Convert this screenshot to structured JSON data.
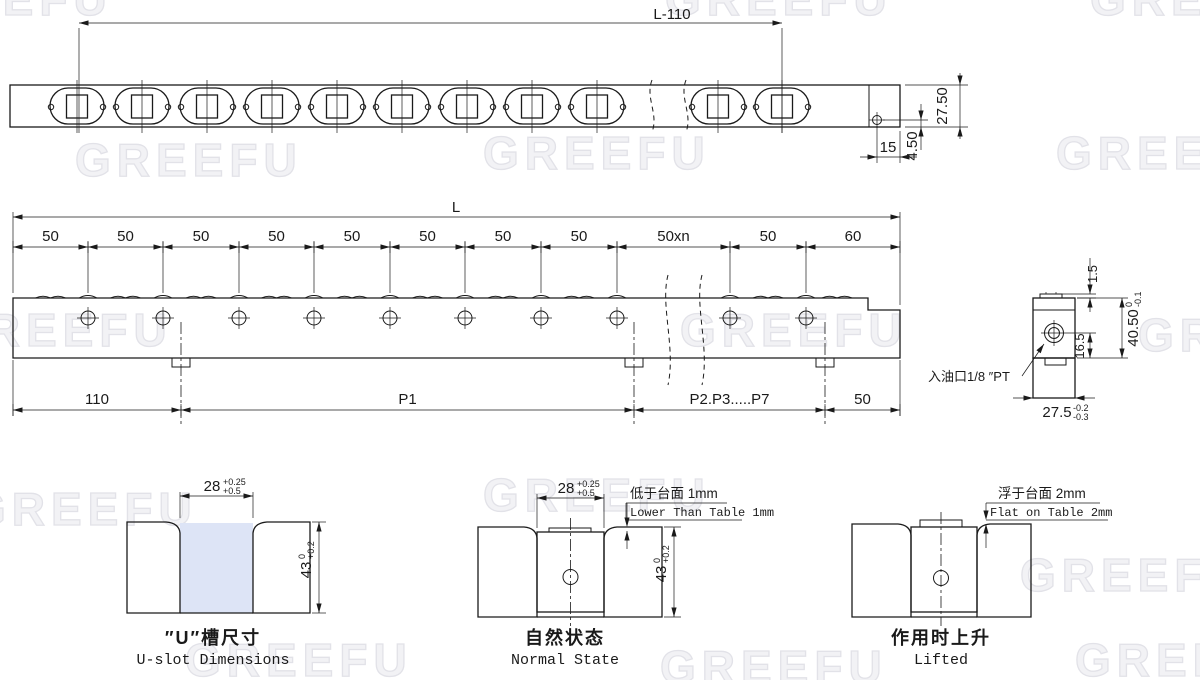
{
  "watermark": {
    "text": "GREEFU"
  },
  "top_view": {
    "length_dim": "L-110",
    "height_dim": "27.50",
    "hole_from_end": "15",
    "hole_from_bottom": "4.50"
  },
  "side_view": {
    "overall_dim": "L",
    "pitch_labels": [
      "50",
      "50",
      "50",
      "50",
      "50",
      "50",
      "50",
      "50",
      "50xn",
      "50",
      "60"
    ],
    "bottom_labels": [
      "110",
      "P1",
      "P2.P3.....P7",
      "50"
    ]
  },
  "section_view": {
    "crown_height": "1.5",
    "hole_to_bottom": "16.5",
    "body_height": {
      "value": "40.50",
      "upper": "0",
      "lower": "-0.1"
    },
    "body_width": {
      "value": "27.5",
      "upper": "-0.2",
      "lower": "-0.3"
    },
    "oil_inlet_label": "入油口1/8 ″PT"
  },
  "details": {
    "uslot": {
      "title_cn": "″U″槽尺寸",
      "title_en": "U-slot Dimensions",
      "width_dim": {
        "value": "28",
        "upper": "+0.25",
        "lower": "+0.5"
      },
      "depth_dim": {
        "value": "43",
        "upper": "0",
        "lower": "+0.2"
      }
    },
    "normal": {
      "title_cn": "自然状态",
      "title_en": "Normal State",
      "width_dim": {
        "value": "28",
        "upper": "+0.25",
        "lower": "+0.5"
      },
      "depth_dim": {
        "value": "43",
        "upper": "0",
        "lower": "+0.2"
      },
      "note_cn": "低于台面 1mm",
      "note_en": "Lower Than Table 1mm"
    },
    "lifted": {
      "title_cn": "作用时上升",
      "title_en": "Lifted",
      "note_cn": "浮于台面 2mm",
      "note_en": "Flat on Table 2mm"
    }
  },
  "colors": {
    "rail_fill": "#dde4f6",
    "block_fill": "#b3b3b3",
    "line": "#1a1a1a",
    "watermark": "#e9e9ec"
  }
}
